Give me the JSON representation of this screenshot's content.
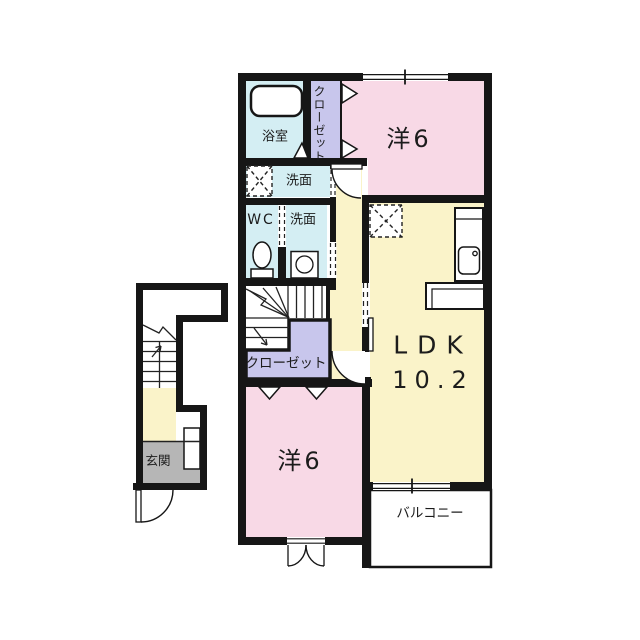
{
  "colors": {
    "wall": "#161616",
    "room_pink": "#F8D9E6",
    "room_yellow": "#FAF3C9",
    "room_cyan": "#D4EEF3",
    "room_purple": "#C8C6EC",
    "room_gray": "#B6B6B6"
  },
  "labels": {
    "bath": "浴室",
    "closet_upper": "クローゼット",
    "bedroom_upper": "洋6",
    "washroom_upper": "洗面",
    "wc": "WC",
    "washroom_lower": "洗面",
    "closet_lower": "クローゼット",
    "bedroom_lower": "洋6",
    "ldk": "LDK",
    "ldk_area": "10.2",
    "balcony": "バルコニー",
    "entrance": "玄関"
  }
}
